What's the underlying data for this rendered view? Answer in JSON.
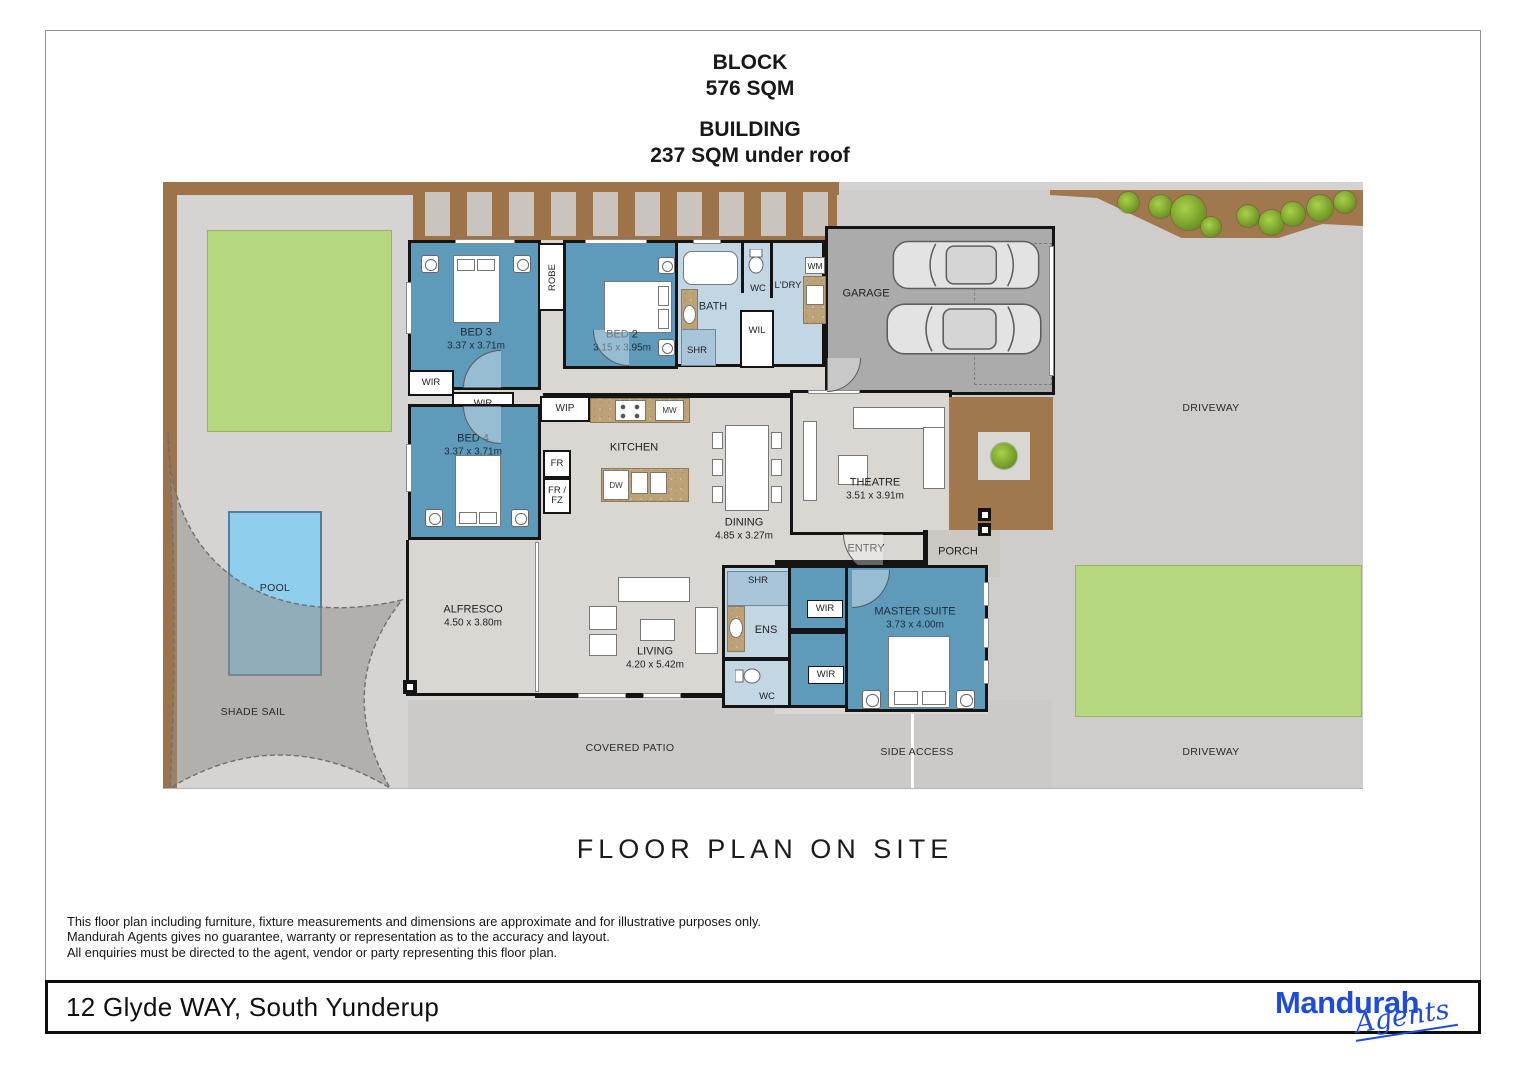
{
  "header": {
    "block_title": "BLOCK",
    "block_value": "576 SQM",
    "building_title": "BUILDING",
    "building_value": "237 SQM under roof"
  },
  "plan_title": "FLOOR PLAN ON SITE",
  "disclaimer_lines": {
    "line1": "This floor plan including furniture, fixture measurements and dimensions are approximate and for illustrative purposes only.",
    "line2": "Mandurah Agents gives no guarantee, warranty or representation as to the accuracy and layout.",
    "line3": "All enquiries must be directed to the agent, vendor or party representing this floor plan."
  },
  "footer": {
    "address": "12 Glyde WAY, South Yunderup",
    "logo_word": "Mandurah",
    "logo_script": "Agents"
  },
  "rooms": {
    "bed3": {
      "name": "BED 3",
      "dims": "3.37 x 3.71m"
    },
    "bed2": {
      "name": "BED 2",
      "dims": "3.15 x 3.95m"
    },
    "bed4": {
      "name": "BED 4",
      "dims": "3.37 x 3.71m"
    },
    "master": {
      "name": "MASTER SUITE",
      "dims": "3.73 x 4.00m"
    },
    "theatre": {
      "name": "THEATRE",
      "dims": "3.51 x 3.91m"
    },
    "dining": {
      "name": "DINING",
      "dims": "4.85 x 3.27m"
    },
    "living": {
      "name": "LIVING",
      "dims": "4.20 x 5.42m"
    },
    "alfresco": {
      "name": "ALFRESCO",
      "dims": "4.50 x 3.80m"
    },
    "kitchen": {
      "name": "KITCHEN"
    },
    "garage": {
      "name": "GARAGE"
    },
    "bath": {
      "name": "BATH"
    },
    "ens": {
      "name": "ENS"
    },
    "entry": {
      "name": "ENTRY"
    },
    "porch": {
      "name": "PORCH"
    }
  },
  "fixtures": {
    "robe": "ROBE",
    "wip": "WIP",
    "wil": "WIL",
    "wir": "WIR",
    "wc": "WC",
    "shr": "SHR",
    "ldry": "L'DRY",
    "wm": "WM",
    "mw": "MW",
    "fr": "FR",
    "frfz": "FR /\nFZ",
    "dw": "DW"
  },
  "site": {
    "pool": "POOL",
    "shade_sail": "SHADE SAIL",
    "covered_patio": "COVERED PATIO",
    "side_access": "SIDE ACCESS",
    "driveway": "DRIVEWAY"
  },
  "colors": {
    "bedroom_blue": "#5e9ab9",
    "wet_area_blue": "#c3d6e4",
    "floor_grey": "#dad6d1",
    "garage_grey": "#ababab",
    "driveway_grey": "#cecdcb",
    "lawn_green": "#b5d77d",
    "pool_blue": "#8fceec",
    "fence_brown": "#9d744a",
    "wall_black": "#141414",
    "logo_blue": "#1d4cdd"
  }
}
